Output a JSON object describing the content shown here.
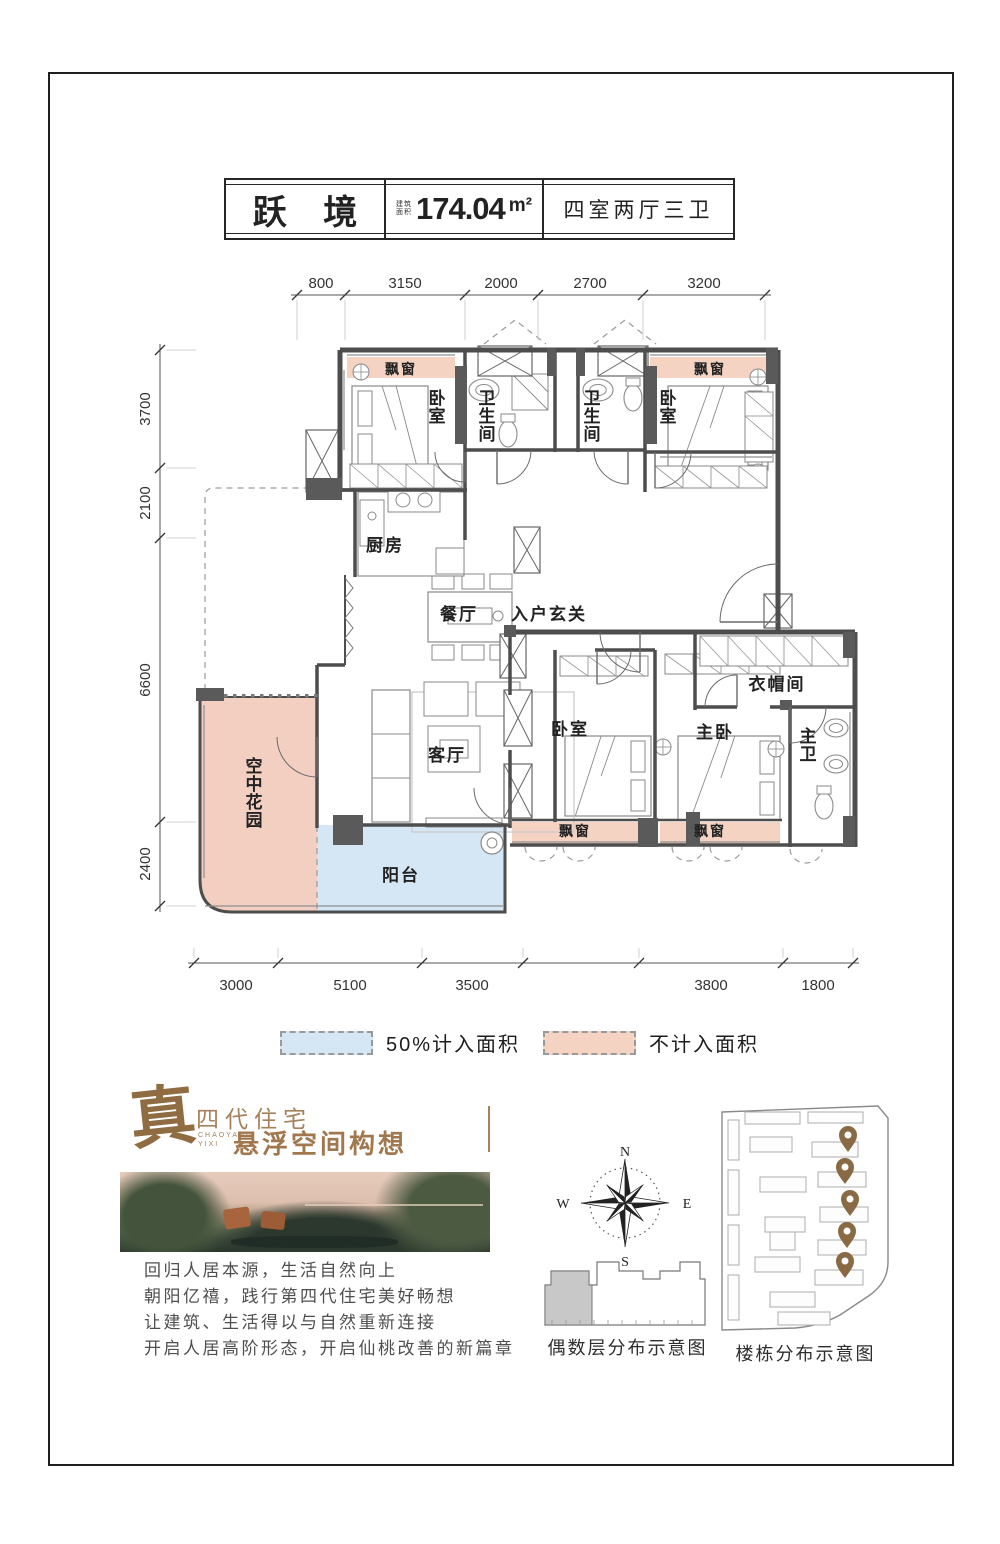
{
  "header": {
    "name": "跃 境",
    "area_label": "建筑面积",
    "area_value": "174.04",
    "area_unit": "m²",
    "layout_type": "四室两厅三卫"
  },
  "plan": {
    "dims_top": [
      "800",
      "3150",
      "2000",
      "2700",
      "3200"
    ],
    "dims_left": [
      "3700",
      "2100",
      "6600",
      "2400"
    ],
    "dims_bottom": [
      "3000",
      "5100",
      "3500",
      "3800",
      "1800"
    ],
    "colors": {
      "bay": "#f4d3c3",
      "garden": "#f2cfc0",
      "balcony": "#d5e6f4",
      "wall": "#4d4d4d"
    },
    "rooms": [
      {
        "label": "飘窗",
        "x": 401,
        "y": 374,
        "s": 14
      },
      {
        "label": "卧室",
        "x": 437,
        "y": 404,
        "v": true
      },
      {
        "label": "卫生间",
        "x": 487,
        "y": 404,
        "v": true
      },
      {
        "label": "卫生间",
        "x": 592,
        "y": 404,
        "v": true
      },
      {
        "label": "卧室",
        "x": 668,
        "y": 404,
        "v": true
      },
      {
        "label": "飘窗",
        "x": 710,
        "y": 374,
        "s": 14
      },
      {
        "label": "厨房",
        "x": 385,
        "y": 551
      },
      {
        "label": "餐厅",
        "x": 459,
        "y": 620
      },
      {
        "label": "入户玄关",
        "x": 549,
        "y": 620
      },
      {
        "label": "客厅",
        "x": 447,
        "y": 761
      },
      {
        "label": "空中花园",
        "x": 254,
        "y": 772,
        "v": true
      },
      {
        "label": "阳台",
        "x": 401,
        "y": 881
      },
      {
        "label": "卧室",
        "x": 570,
        "y": 735
      },
      {
        "label": "主卧",
        "x": 715,
        "y": 738
      },
      {
        "label": "衣帽间",
        "x": 777,
        "y": 690
      },
      {
        "label": "主卫",
        "x": 808,
        "y": 742,
        "v": true
      },
      {
        "label": "飘窗",
        "x": 575,
        "y": 836,
        "s": 14
      },
      {
        "label": "飘窗",
        "x": 710,
        "y": 836,
        "s": 14
      }
    ]
  },
  "legend": {
    "items": [
      {
        "label": "50%计入面积",
        "color": "#d5e6f4"
      },
      {
        "label": "不计入面积",
        "color": "#f4d3c3"
      }
    ]
  },
  "branding": {
    "seal": "真",
    "title": "四代住宅",
    "sub1": "CHAOYANG",
    "sub2": "YIXI",
    "slogan": "悬浮空间构想",
    "accent": "#a0805a",
    "copy": [
      "回归人居本源，生活自然向上",
      "朝阳亿禧，践行第四代住宅美好畅想",
      "让建筑、生活得以与自然重新连接",
      "开启人居高阶形态，开启仙桃改善的新篇章"
    ]
  },
  "compass": {
    "n": "N",
    "e": "E",
    "s": "S",
    "w": "W"
  },
  "diagrams": {
    "floor_label": "偶数层分布示意图",
    "site_label": "楼栋分布示意图"
  }
}
